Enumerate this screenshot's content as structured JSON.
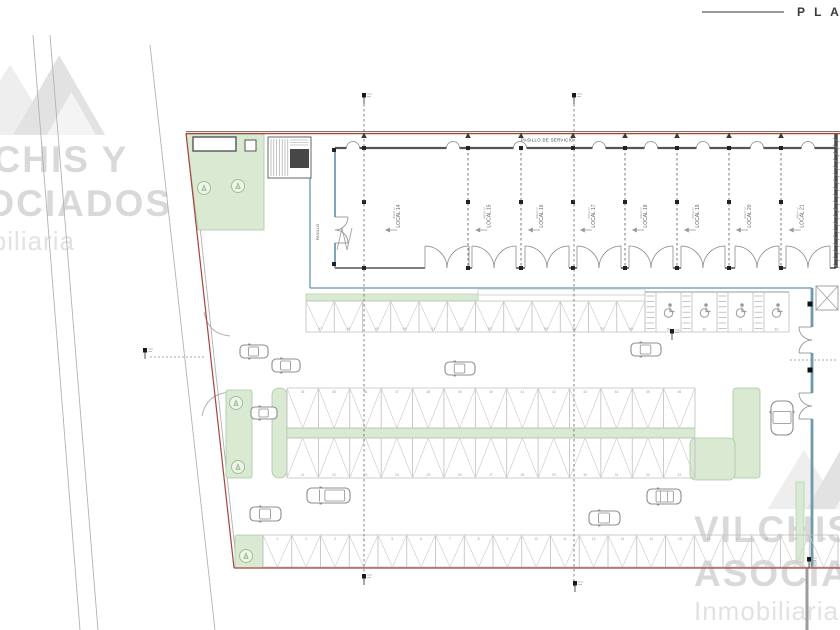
{
  "header": {
    "title": "P L A"
  },
  "watermarks": {
    "left": {
      "line1": "VILCHIS Y",
      "line2": "ASOCIADOS",
      "line3": "Inmobiliaria"
    },
    "right": {
      "line1": "VILCHIS",
      "line2": "ASOCIADOS",
      "line3": "Inmobiliaria"
    }
  },
  "plan": {
    "service_corridor_label": "PASILLO DE SERVICIO",
    "side_corridor_label": "PASILLO",
    "locales": [
      {
        "name": "LOCAL 14",
        "area": "ÁREA m²"
      },
      {
        "name": "LOCAL 15",
        "area": "ÁREA m²"
      },
      {
        "name": "LOCAL 16",
        "area": "ÁREA m²"
      },
      {
        "name": "LOCAL 17",
        "area": "ÁREA m²"
      },
      {
        "name": "LOCAL 18",
        "area": "ÁREA m²"
      },
      {
        "name": "LOCAL 19",
        "area": "ÁREA m²"
      },
      {
        "name": "LOCAL 20",
        "area": "ÁREA m²"
      },
      {
        "name": "LOCAL 21",
        "area": "ÁREA m²"
      }
    ],
    "parking": {
      "top_row_numbers": [
        "47",
        "48",
        "49",
        "50",
        "51",
        "52",
        "53",
        "54",
        "55",
        "56",
        "57",
        "58"
      ],
      "handicap_numbers": [
        "59",
        "60",
        "61",
        "62"
      ],
      "mid_top_numbers": [
        "34",
        "35",
        "36",
        "37",
        "38",
        "39",
        "40",
        "41",
        "42",
        "43",
        "44",
        "45",
        "46"
      ],
      "mid_bottom_numbers": [
        "21",
        "22",
        "23",
        "24",
        "25",
        "26",
        "27",
        "28",
        "29",
        "30",
        "31",
        "32",
        "33"
      ],
      "bottom_row_numbers": [
        "1",
        "2",
        "3",
        "4",
        "5",
        "6",
        "7",
        "8",
        "9",
        "10",
        "11",
        "12",
        "13",
        "14",
        "15",
        "16",
        "17",
        "18",
        "19",
        "20"
      ]
    },
    "colors": {
      "boundary_red": "#a8443c",
      "boundary_dark": "#6e625c",
      "wall_dark": "#4a4a4a",
      "wall_blue": "#7fa6b8",
      "green_fill": "#d9e9d2",
      "green_stroke": "#a9c8a0",
      "line_light": "#bdbdbd",
      "zig_light": "#cfcfcf",
      "car_gray": "#8c8c8c",
      "number_gray": "#9f9f9f",
      "watermark_gray": "#d9d9d9"
    }
  }
}
